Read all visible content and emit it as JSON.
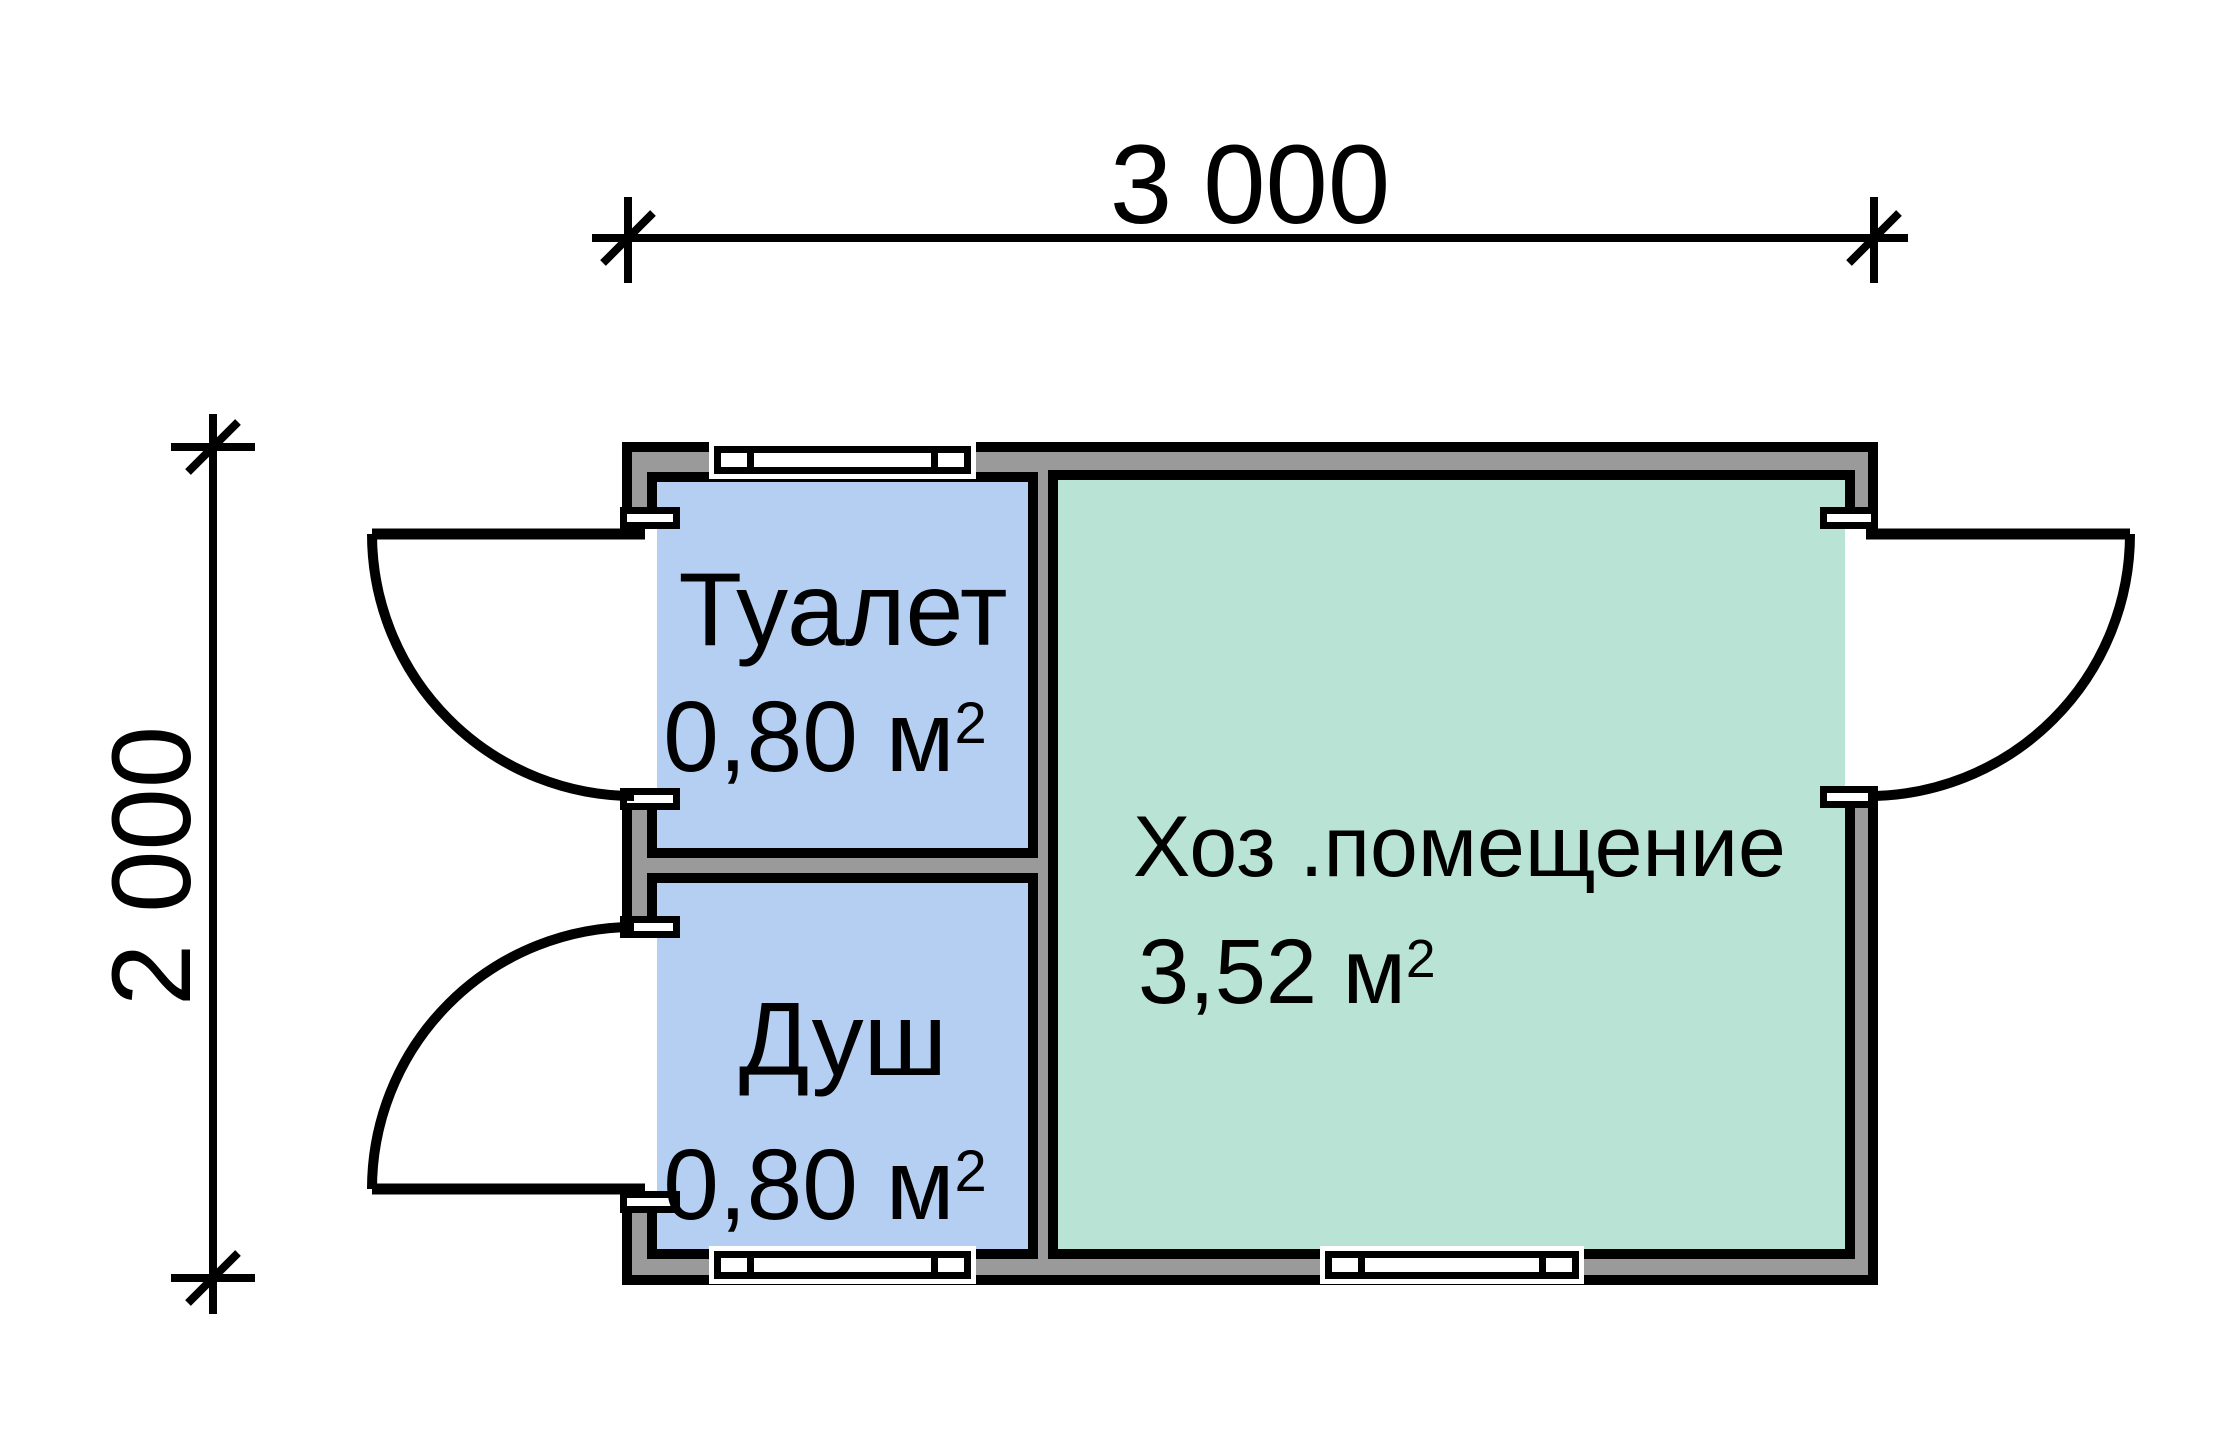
{
  "plan": {
    "type": "floor-plan",
    "background": "#ffffff",
    "wall_fill": "#9a9a9a",
    "line_color": "#000000",
    "dimensions": {
      "width_label": "3 000",
      "height_label": "2 000"
    },
    "rooms": [
      {
        "name": "Туалет",
        "area": "0,80 м",
        "area_sup": "2",
        "fill": "#b5cff2"
      },
      {
        "name": "Душ",
        "area": "0,80 м",
        "area_sup": "2",
        "fill": "#b5cff2"
      },
      {
        "name": "Хоз .помещение",
        "area": "3,52 м",
        "area_sup": "2",
        "fill": "#b8e3d5"
      }
    ]
  }
}
